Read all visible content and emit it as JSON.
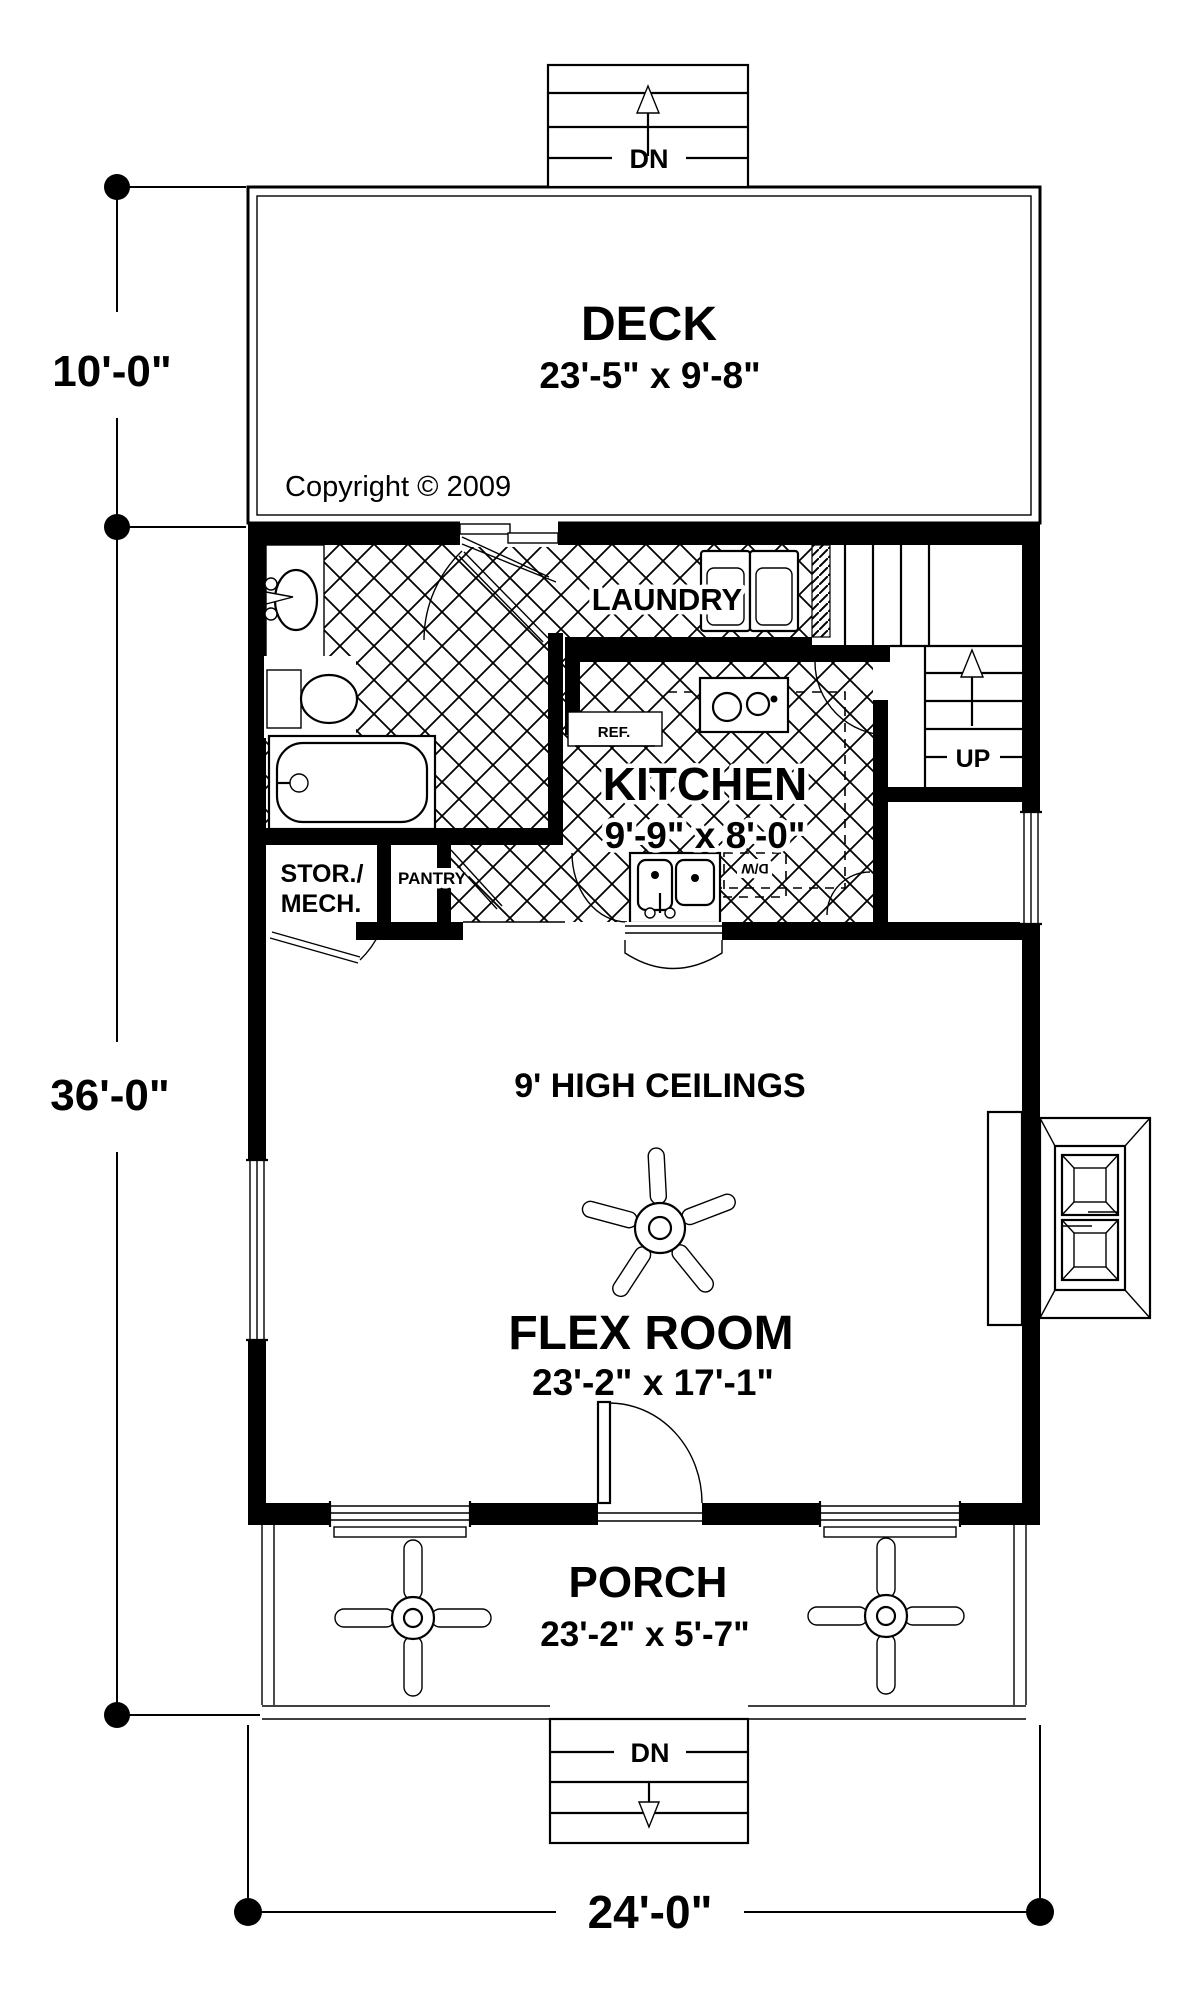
{
  "copyright": "Copyright © 2009",
  "dimensions": {
    "deck_depth": "10'-0\"",
    "house_depth": "36'-0\"",
    "house_width": "24'-0\""
  },
  "rooms": {
    "deck": {
      "name": "DECK",
      "size": "23'-5\" x 9'-8\""
    },
    "laundry": {
      "name": "LAUNDRY"
    },
    "kitchen": {
      "name": "KITCHEN",
      "size": "9'-9\" x 8'-0\""
    },
    "storage": {
      "line1": "STOR./",
      "line2": "MECH."
    },
    "pantry": {
      "name": "PANTRY"
    },
    "flex": {
      "name": "FLEX ROOM",
      "size": "23'-2\" x 17'-1\"",
      "note": "9' HIGH CEILINGS"
    },
    "porch": {
      "name": "PORCH",
      "size": "23'-2\" x 5'-7\""
    }
  },
  "stairs": {
    "deck_stairs_label": "DN",
    "interior_stairs_label": "UP",
    "porch_stairs_label": "DN"
  },
  "appliances": {
    "refrigerator": "REF.",
    "dishwasher": "D/W"
  },
  "colors": {
    "ink": "#000000",
    "paper": "#ffffff"
  }
}
